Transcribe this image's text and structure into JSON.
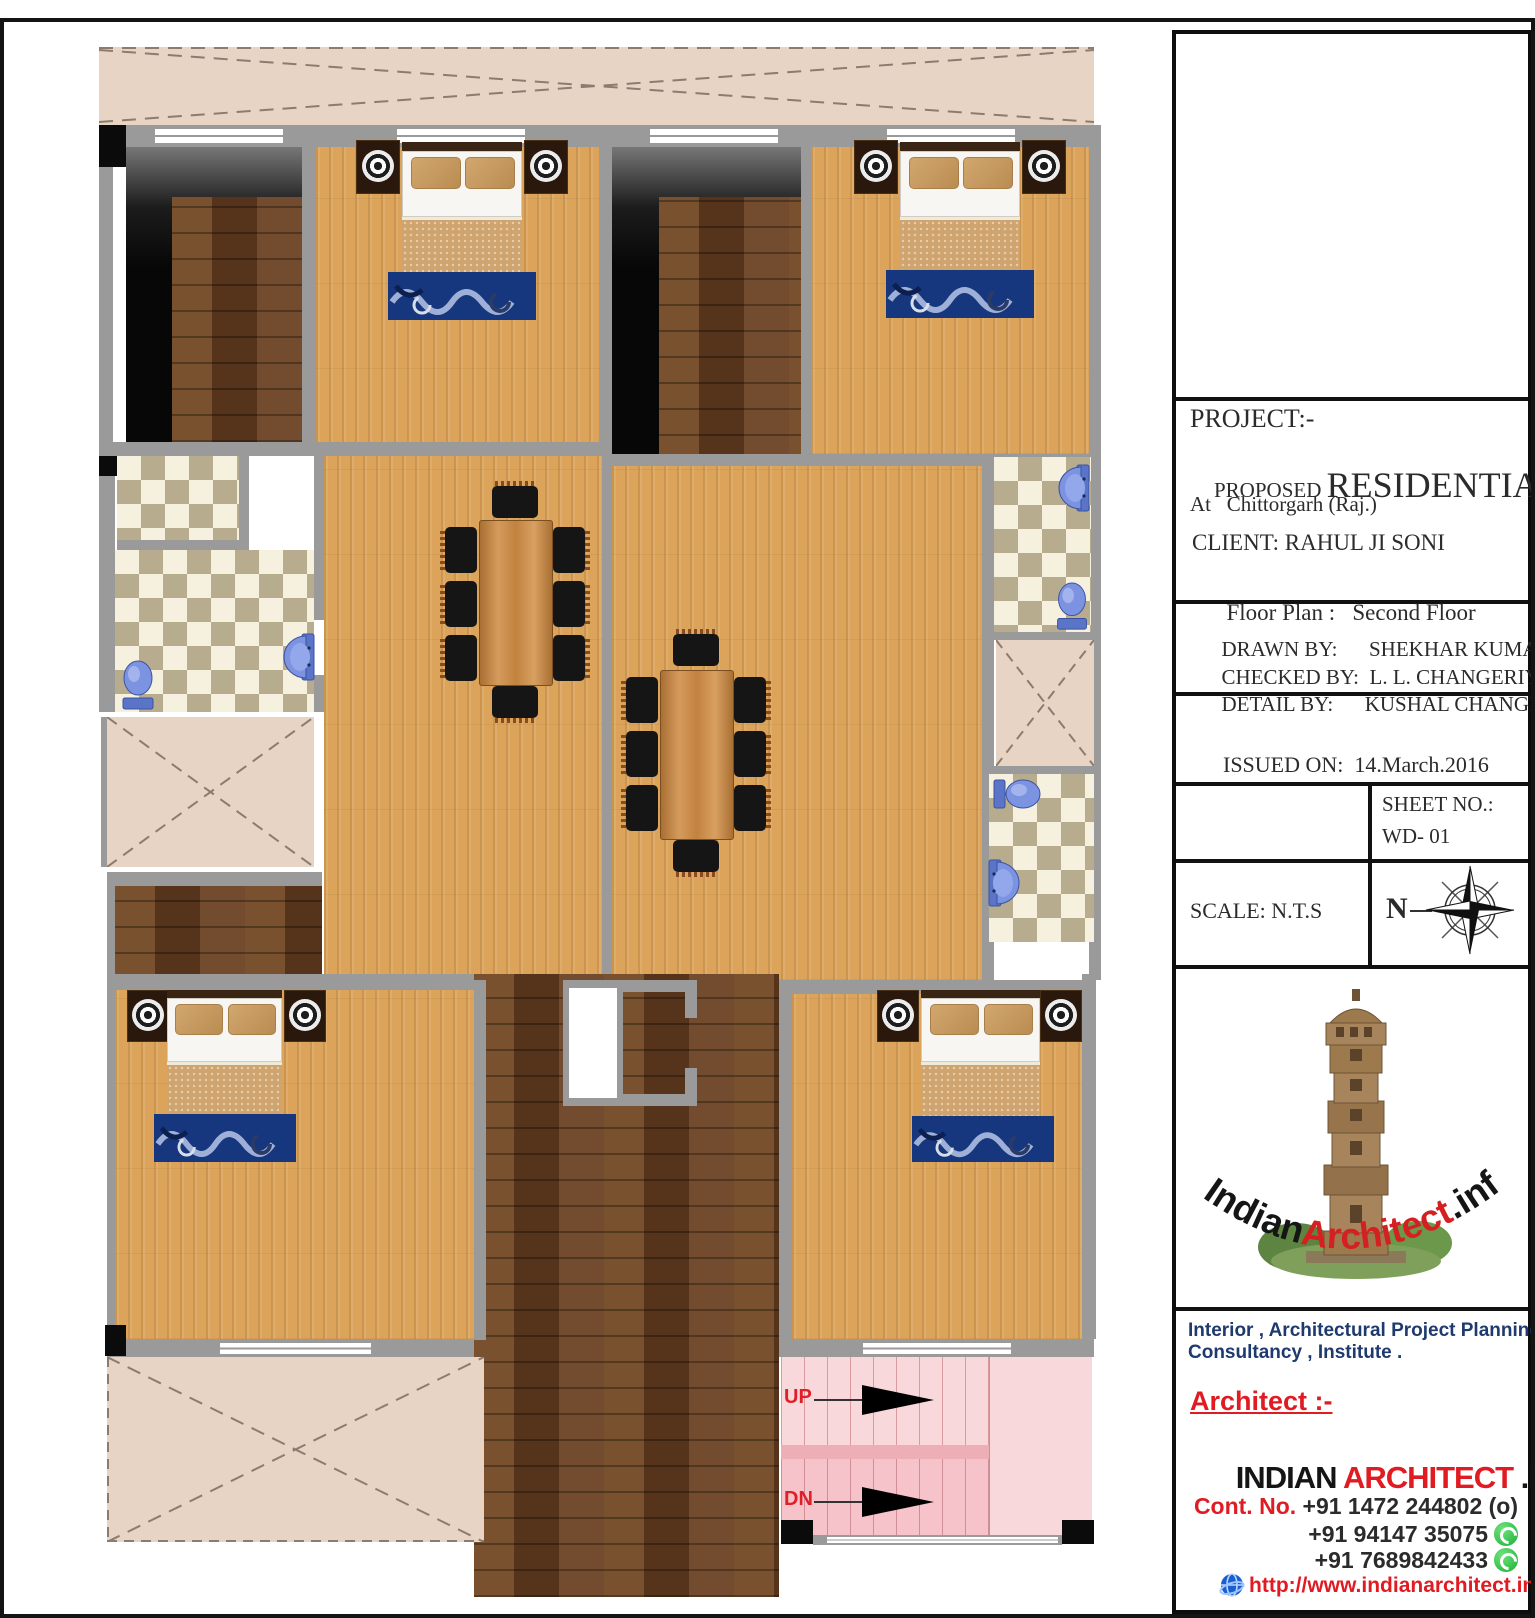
{
  "title_block": {
    "project_label": "PROJECT:-",
    "proposed_label": "PROPOSED ",
    "project_name": "RESIDENTIAL",
    "location": "At   Chittorgarh (Raj.)",
    "client": "CLIENT: RAHUL JI SONI",
    "floor_plan_label": "Floor Plan :   ",
    "floor_plan_value": "Second Floor",
    "drawn_by_label": "DRAWN BY:      ",
    "drawn_by": "SHEKHAR KUMAWAT",
    "checked_by_label": "CHECKED BY:  ",
    "checked_by": "L. L. CHANGERIYA",
    "detail_by_label": "DETAIL BY:      ",
    "detail_by": "KUSHAL CHANGERIYA",
    "issued_on_label": "ISSUED ON:  ",
    "issued_on": "14.March.2016",
    "sheet_no_label": "SHEET NO.:",
    "sheet_no": "WD- 01",
    "scale": "SCALE: N.T.S",
    "compass_letter": "N"
  },
  "logo": {
    "text_indian": "Indian",
    "text_architect": "Architect",
    "text_info": ".info"
  },
  "footer": {
    "services_line1": "Interior , Architectural Project Planning,",
    "services_line2": "Consultancy , Institute .",
    "architect_label": "Architect :-",
    "brand_indian": "INDIAN ",
    "brand_architect": "ARCHITECT ",
    "brand_info": ".INFO",
    "contact_label": "Cont. No. ",
    "phone1": "+91 1472 244802 (o)",
    "phone2": "+91 94147 35075",
    "phone3": "+91 7689842433",
    "website": "http://www.indianarchitect.info/",
    "email": "info@.indianarchitect.info/"
  },
  "plan": {
    "stairs": {
      "up_label": "UP",
      "dn_label": "DN"
    }
  },
  "colors": {
    "brand_red": "#e11b22",
    "services_navy": "#1e3a6e",
    "wall_gray": "#9a9a9a",
    "oak_floor": "#dba45a",
    "walnut_floor": "#6a4122",
    "stair_pink": "#f8d7da",
    "fixture_blue": "#6f87d8",
    "tile_dark": "#b7ad8e",
    "tile_light": "#f6f1df",
    "balcony_beige": "#e7d4c5",
    "whatsapp_green": "#1cae38"
  }
}
